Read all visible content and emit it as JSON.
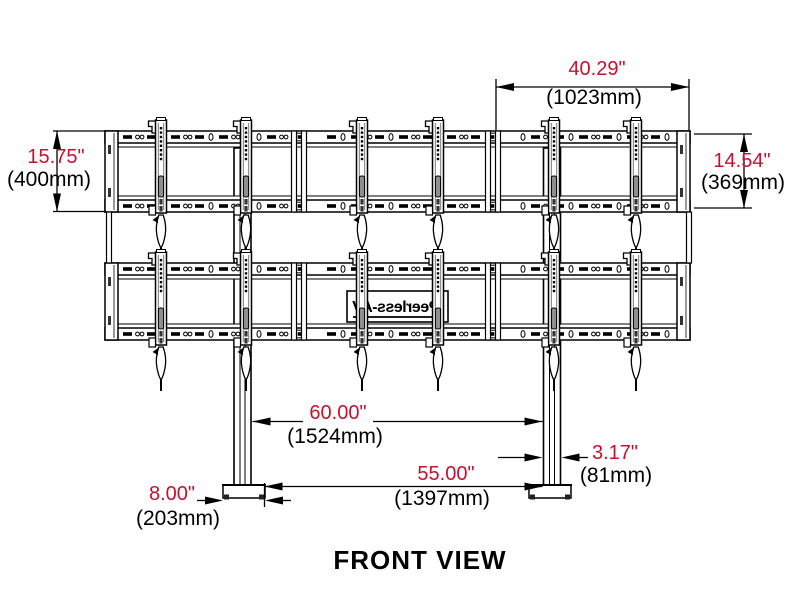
{
  "view_label": "FRONT VIEW",
  "logo": {
    "brand": "Peerless-AV",
    "mirrored": true
  },
  "colors": {
    "dimension_red": "#C8102E",
    "line_black": "#000000",
    "background": "#FFFFFF",
    "slot_gray": "#8f8f8f"
  },
  "dims": {
    "left_height": {
      "in": "15.75\"",
      "mm": "(400mm)"
    },
    "top_width": {
      "in": "40.29\"",
      "mm": "(1023mm)"
    },
    "right_height": {
      "in": "14.54\"",
      "mm": "(369mm)"
    },
    "pole_span": {
      "in": "60.00\"",
      "mm": "(1524mm)"
    },
    "base_span": {
      "in": "55.00\"",
      "mm": "(1397mm)"
    },
    "pole_width": {
      "in": "3.17\"",
      "mm": "(81mm)"
    },
    "base_width": {
      "in": "8.00\"",
      "mm": "(203mm)"
    }
  }
}
